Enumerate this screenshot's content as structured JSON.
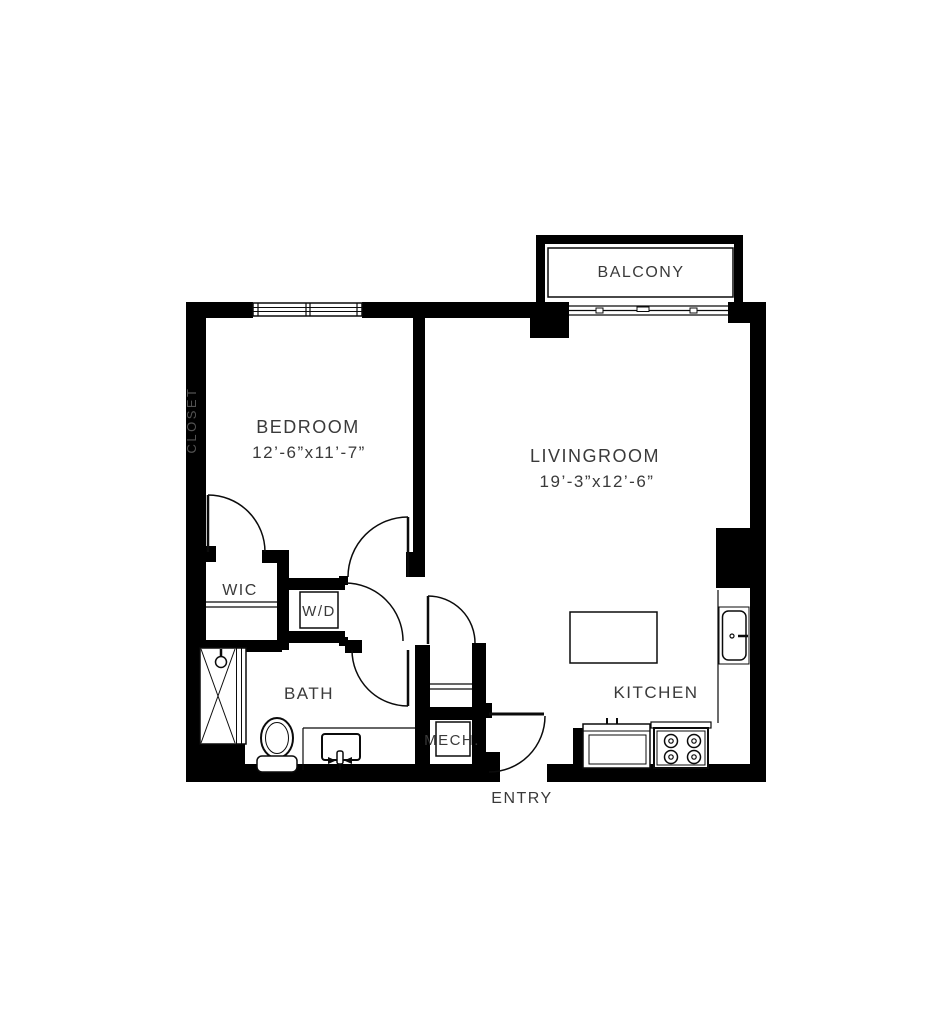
{
  "page": {
    "title": "One-bedroom apartment floor plan",
    "background": "#ffffff"
  },
  "palette": {
    "wall": "#000000",
    "line": "#0b0b0b",
    "label": "#3a3a3a",
    "wall_label": "#525252"
  },
  "floorplan": {
    "balcony": {
      "label": "BALCONY"
    },
    "closet": {
      "label": "CLOSET"
    },
    "bedroom": {
      "label": "BEDROOM",
      "dimensions": "12’-6”x11’-7”"
    },
    "livingroom": {
      "label": "LIVINGROOM",
      "dimensions": "19’-3”x12’-6”"
    },
    "wic": {
      "label": "WIC"
    },
    "laundry": {
      "label": "W/D"
    },
    "bath": {
      "label": "BATH",
      "fixtures": [
        "shower",
        "toilet",
        "vanity-sink"
      ]
    },
    "mech": {
      "label": "MECH."
    },
    "entry": {
      "label": "ENTRY"
    },
    "kitchen": {
      "label": "KITCHEN",
      "fixtures": [
        "island",
        "wall-sink",
        "counter-sink",
        "stove-4-burner"
      ]
    }
  }
}
